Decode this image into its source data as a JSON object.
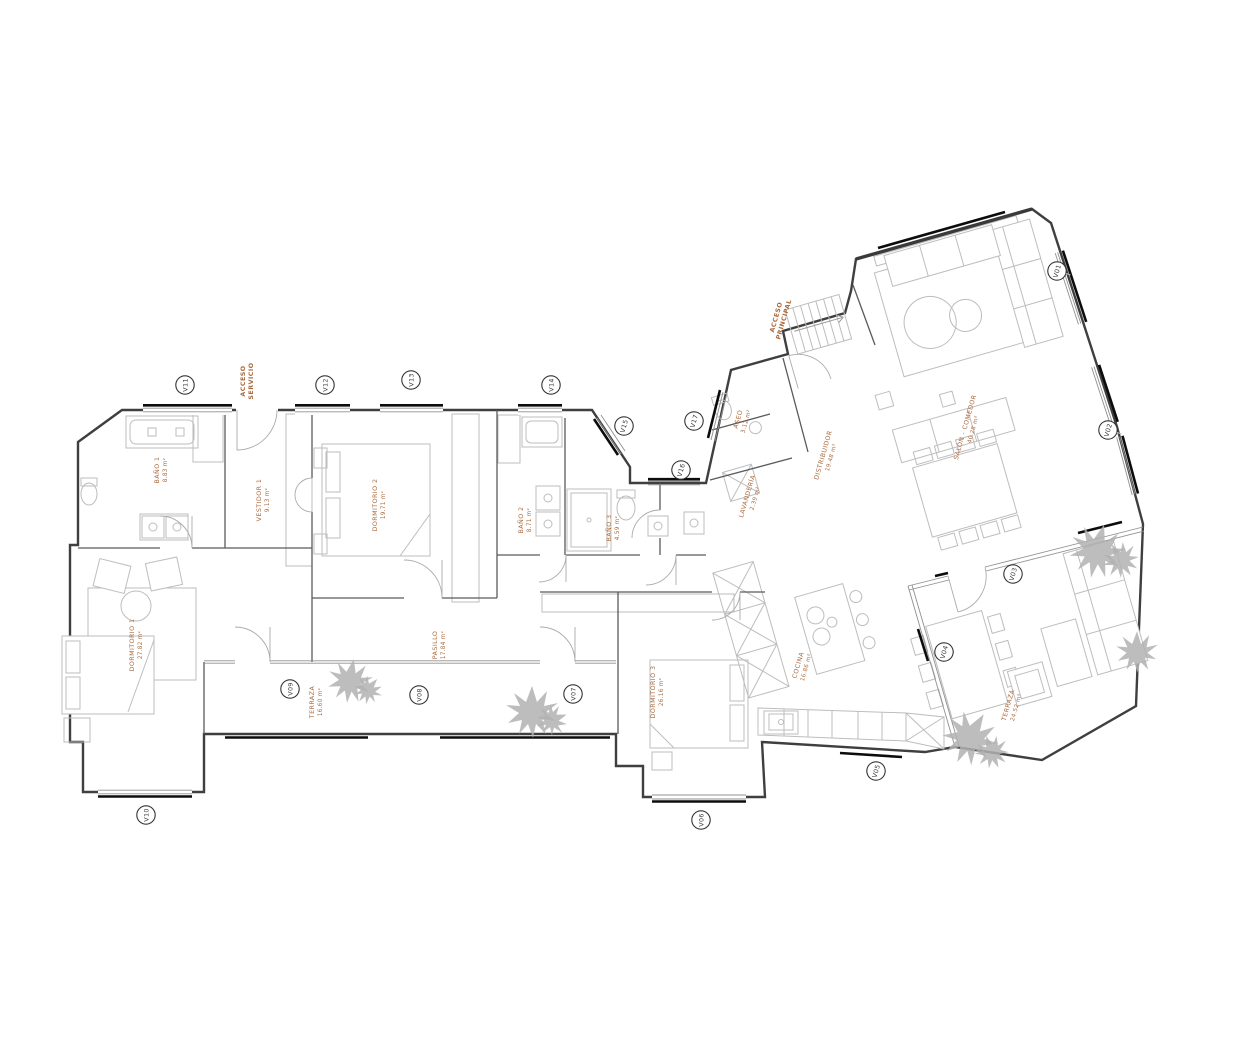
{
  "rooms": [
    {
      "name": "BAÑO 1",
      "area": "8.83 m²"
    },
    {
      "name": "VESTIDOR 1",
      "area": "9.13 m²"
    },
    {
      "name": "DORMITORIO 2",
      "area": "19.71 m²"
    },
    {
      "name": "DORMITORIO 1",
      "area": "27.82 m²"
    },
    {
      "name": "PASILLO",
      "area": "17.84 m²"
    },
    {
      "name": "BAÑO 2",
      "area": "8.71 m²"
    },
    {
      "name": "BAÑO 3",
      "area": "4.59 m²"
    },
    {
      "name": "ASEO",
      "area": "3.12 m²"
    },
    {
      "name": "LAVANDERÍA",
      "area": "2.39 m²"
    },
    {
      "name": "DISTRIBUIDOR",
      "area": "19.48 m²"
    },
    {
      "name": "SALÓN - COMEDOR",
      "area": "40.28 m²"
    },
    {
      "name": "COCINA",
      "area": "16.86 m²"
    },
    {
      "name": "TERRAZA",
      "area": "24.52 m²"
    },
    {
      "name": "TERRAZA",
      "area": "16.60 m²"
    },
    {
      "name": "DORMITORIO 3",
      "area": "26.16 m²"
    }
  ],
  "access": {
    "servicio": {
      "l1": "ACCESO",
      "l2": "SERVICIO"
    },
    "principal": {
      "l1": "ACCESO",
      "l2": "PRINCIPAL"
    }
  },
  "windows": [
    {
      "id": "V01"
    },
    {
      "id": "V02"
    },
    {
      "id": "V03"
    },
    {
      "id": "V04"
    },
    {
      "id": "V05"
    },
    {
      "id": "V06"
    },
    {
      "id": "V07"
    },
    {
      "id": "V08"
    },
    {
      "id": "V09"
    },
    {
      "id": "V10"
    },
    {
      "id": "V11"
    },
    {
      "id": "V12"
    },
    {
      "id": "V13"
    },
    {
      "id": "V14"
    },
    {
      "id": "V15"
    },
    {
      "id": "V16"
    },
    {
      "id": "V17"
    }
  ],
  "colors": {
    "label_accent": "#ab6a3e",
    "wall": "#3f3f3f",
    "furniture": "#bdbdbd"
  }
}
